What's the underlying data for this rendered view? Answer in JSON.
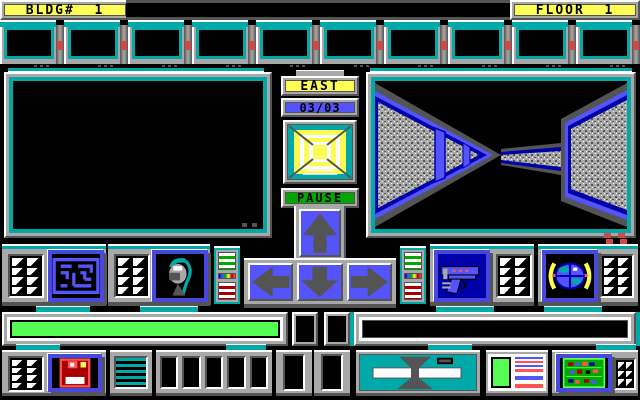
{
  "header": {
    "bldg_label": "BLDG#  1",
    "floor_label": "FLOOR  1"
  },
  "compass": {
    "direction": "EAST",
    "position": "03/03"
  },
  "controls": {
    "pause_label": "PAUSE",
    "dpad_buttons": [
      "up",
      "left",
      "down",
      "right"
    ],
    "panel_buttons": [
      "maze-map",
      "droid",
      "gun",
      "globe",
      "floppy-disk",
      "circuit-board"
    ]
  },
  "status": {
    "health_fill_percent": 100,
    "energy_fill_percent": 100,
    "message_text": ""
  },
  "monitors": {
    "count": 10,
    "state": "blank"
  },
  "colors": {
    "teal": "#00a8a8",
    "yellow": "#fcfc54",
    "blue": "#5454fc",
    "dark_blue": "#0000a8",
    "green": "#00a800",
    "bright_green": "#54fc54",
    "red": "#a80000",
    "bright_red": "#fc5454",
    "gray": "#a8a8a8",
    "dark_gray": "#545454",
    "white": "#fcfcfc",
    "black": "#000000"
  }
}
